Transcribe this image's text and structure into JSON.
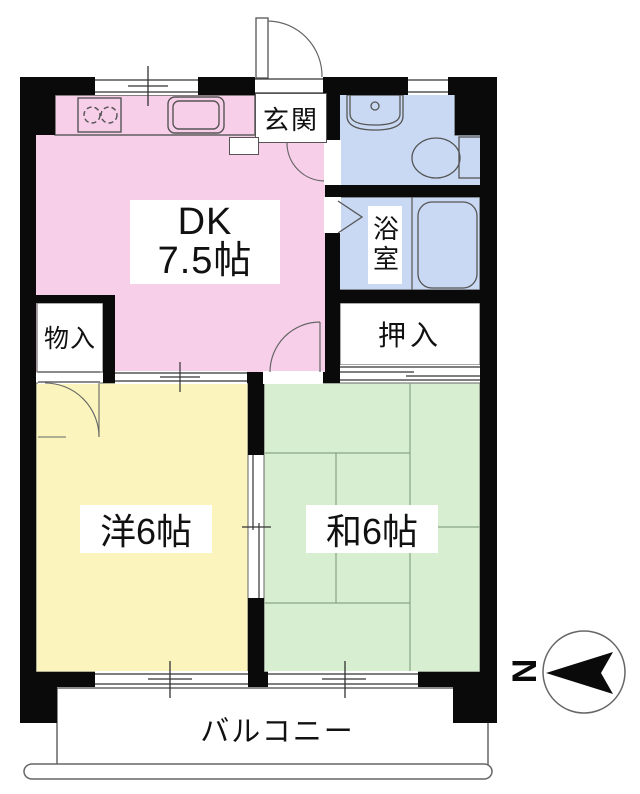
{
  "title": "apartment floor plan",
  "unit": {
    "rooms": {
      "dk": {
        "name_line1": "DK",
        "name_line2": "7.5帖",
        "size_jo": 7.5,
        "color": "#f8cfe9"
      },
      "genkan": {
        "name": "玄関",
        "color": "#ffffff"
      },
      "washroom_toilet": {
        "color": "#c9d9f3"
      },
      "bathroom": {
        "name": "浴室",
        "color": "#c9d9f3"
      },
      "mono_ire": {
        "name": "物入",
        "color": "#ffffff"
      },
      "oshiire": {
        "name": "押入",
        "color": "#ffffff"
      },
      "western_room": {
        "name": "洋6帖",
        "size_jo": 6,
        "color": "#fbf5bd"
      },
      "japanese_room": {
        "name": "和6帖",
        "size_jo": 6,
        "color": "#d7eed0"
      },
      "balcony": {
        "name": "バルコニー",
        "color": "#ffffff"
      }
    },
    "fixtures": [
      "stove-2-burner",
      "kitchen-sink",
      "wash-basin",
      "toilet",
      "bathtub",
      "tatami-6-mats"
    ],
    "compass": {
      "north_label": "N",
      "direction": "left"
    },
    "wall_color": "#0a0a0a",
    "line_color": "#555555"
  }
}
